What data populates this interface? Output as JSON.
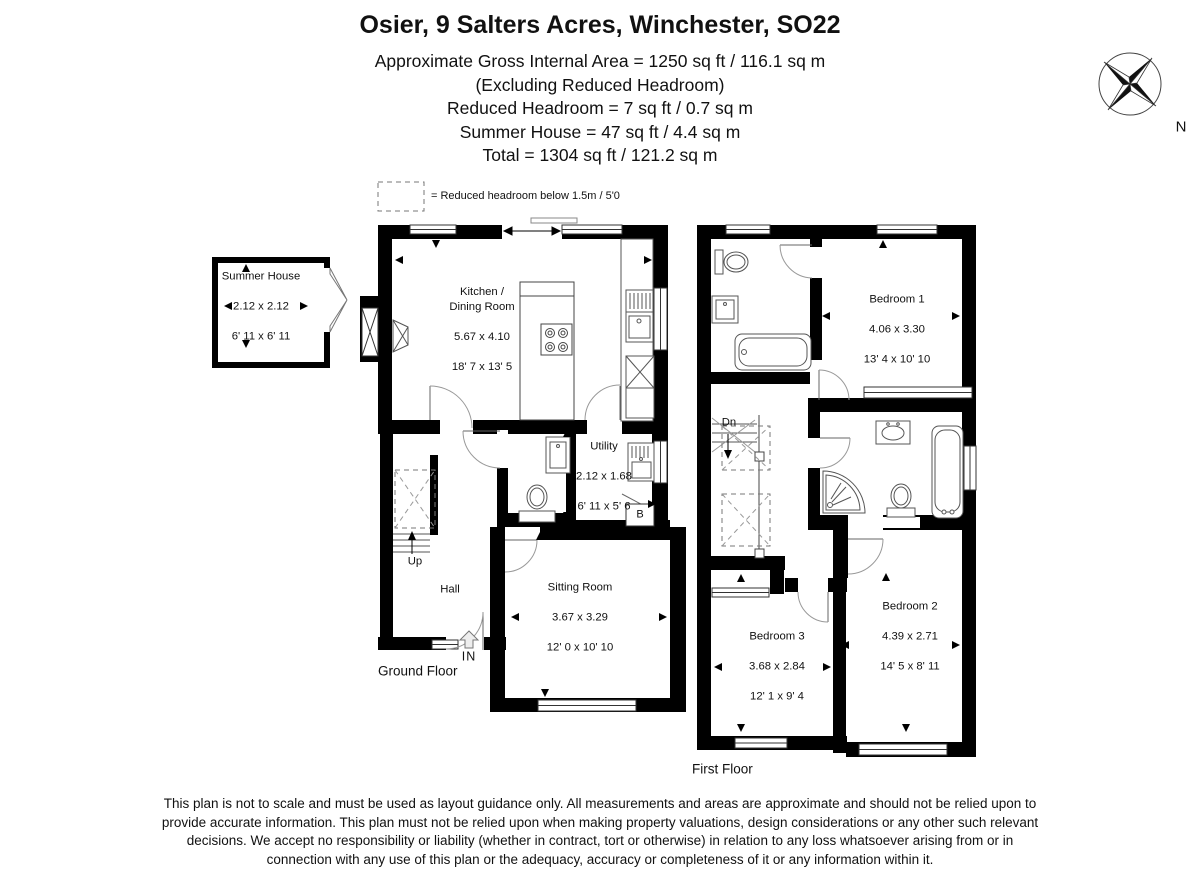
{
  "header": {
    "title": "Osier, 9 Salters Acres, Winchester, SO22",
    "area_lines": [
      "Approximate Gross Internal Area = 1250 sq ft / 116.1 sq m",
      "(Excluding Reduced Headroom)",
      "Reduced Headroom = 7 sq ft / 0.7 sq m",
      "Summer House = 47 sq ft / 4.4 sq m",
      "Total = 1304 sq ft / 121.2 sq m"
    ]
  },
  "legend": {
    "reduced_headroom": "= Reduced headroom below 1.5m / 5'0"
  },
  "compass": {
    "north": "N"
  },
  "summer_house": {
    "name": "Summer House",
    "metric": "2.12 x 2.12",
    "imperial": "6' 11 x 6' 11"
  },
  "ground_floor": {
    "label": "Ground Floor",
    "kitchen": {
      "name": "Kitchen /\nDining Room",
      "metric": "5.67 x 4.10",
      "imperial": "18' 7 x 13' 5"
    },
    "utility": {
      "name": "Utility",
      "metric": "2.12 x 1.68",
      "imperial": "6' 11 x 5' 6"
    },
    "sitting_room": {
      "name": "Sitting Room",
      "metric": "3.67 x 3.29",
      "imperial": "12' 0 x 10' 10"
    },
    "hall": "Hall",
    "stairs_up": "Up",
    "entrance": "IN",
    "boiler": "B"
  },
  "first_floor": {
    "label": "First Floor",
    "bedroom1": {
      "name": "Bedroom 1",
      "metric": "4.06 x 3.30",
      "imperial": "13' 4 x 10' 10"
    },
    "bedroom2": {
      "name": "Bedroom 2",
      "metric": "4.39 x 2.71",
      "imperial": "14' 5 x 8' 11"
    },
    "bedroom3": {
      "name": "Bedroom 3",
      "metric": "3.68 x 2.84",
      "imperial": "12' 1 x 9' 4"
    },
    "stairs_down": "Dn"
  },
  "disclaimer": "This plan is not to scale and must be used as layout guidance only. All measurements and areas are approximate and should not be relied upon to\nprovide accurate information. This plan must not be relied upon when making property valuations, design considerations or any other such relevant\ndecisions. We accept no responsibility or liability (whether in contract, tort or otherwise) in relation to any loss whatsoever arising from or in\nconnection with any use of this plan or the adequacy, accuracy or completeness of it or any information within it."
}
